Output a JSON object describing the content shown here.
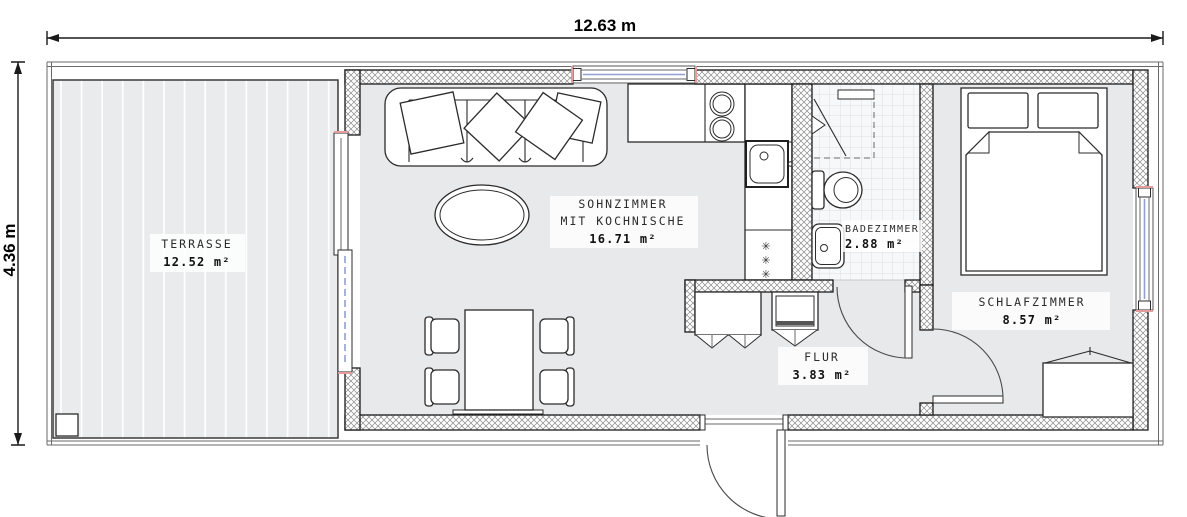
{
  "plan": {
    "dimensions": {
      "width_label": "12.63 m",
      "height_label": "4.36 m"
    },
    "rooms": {
      "terrasse": {
        "name": "TERRASSE",
        "area": "12.52 m²"
      },
      "wohnzimmer": {
        "name_line1": "SOHNZIMMER",
        "name_line2": "MIT KOCHNISCHE",
        "area": "16.71 m²"
      },
      "badezimmer": {
        "name": "BADEZIMMER",
        "area": "2.88 m²"
      },
      "schlafzimmer": {
        "name": "SCHLAFZIMMER",
        "area": "8.57 m²"
      },
      "flur": {
        "name": "FLUR",
        "area": "3.83 m²"
      }
    },
    "symbols": {
      "kitchen_marker": "✳"
    },
    "colors": {
      "floor_gray": "#e8e9ea",
      "wall_line": "#1c1c1c",
      "glass_blue": "#92a0cf",
      "tile_line": "#dcdee0",
      "accent_red": "#e59c9c"
    }
  }
}
